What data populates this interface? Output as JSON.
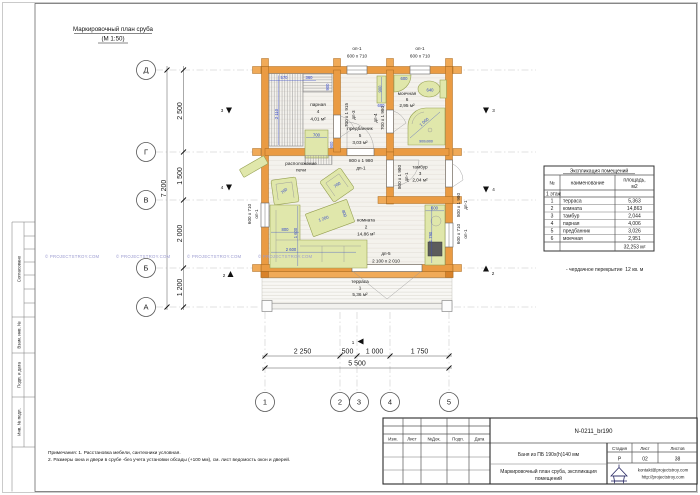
{
  "sheet": {
    "plan_title_1": "Маркировочный план сруба",
    "plan_title_2": "(М 1:50)",
    "watermark": "© PROJECTSTROY.COM",
    "note_1": "Примечания: 1. Расстановка мебели, сантехники условная.",
    "note_2": "2. Размеры окна и двери в срубе -без учета установки обсады (+100 мм), см. лист ведомость окон и дверей."
  },
  "frame": {
    "approved": "Согласовано",
    "replace_inv": "Взам. инв. №",
    "sign_date": "Подп. и дата",
    "inv_num": "Инв. № подл."
  },
  "axes": {
    "v": [
      "Д",
      "Г",
      "В",
      "Б",
      "А"
    ],
    "h": [
      "1",
      "2",
      "3",
      "4",
      "5"
    ]
  },
  "dims": {
    "left": [
      "2 500",
      "1 500",
      "2 000",
      "1 200"
    ],
    "left_total": "7 200",
    "bottom": [
      "2 250",
      "500",
      "1 000",
      "1 750"
    ],
    "bottom_total": "5 500"
  },
  "openings": {
    "win": "оп-1",
    "win_size": "600 х 710",
    "d1": "дп-1",
    "d1_size": "800 х 1 980",
    "d3": "дп-3",
    "d3_size": "700 х 1 915",
    "d4": "дп-4",
    "d4_size": "700 х 1 980",
    "d5": "дп-5",
    "d5_size": "2 100 х 2 010"
  },
  "rooms": {
    "parnaya": {
      "name": "парная",
      "num": "4",
      "area": "4,01 м²"
    },
    "predbannik": {
      "name": "предбанник",
      "num": "5",
      "area": "3,03 м²"
    },
    "moechnaya": {
      "name": "моечная",
      "num": "6",
      "area": "2,95 м²"
    },
    "komnata": {
      "name": "комната",
      "num": "2",
      "area": "14,86 м²"
    },
    "tambur": {
      "name": "тамбур",
      "num": "3",
      "area": "2,04 м²"
    },
    "terrasa": {
      "name": "терраса",
      "num": "1",
      "area": "5,36 м²"
    }
  },
  "stove": {
    "note_1": "расположение",
    "note_2": "печи"
  },
  "furn": {
    "bench_a": "570",
    "bench_b": "360",
    "bench_len": "2 110",
    "bench_side": "900",
    "stove_w": "700",
    "stove_d": "900",
    "shelf_len": "900",
    "shelf_w": "600",
    "sink": "600",
    "wc": "640",
    "shower_diag": "1 000",
    "shower_size": "900х900",
    "chair": "700",
    "table_l": "1 200",
    "table_w": "800",
    "sofa_w": "800",
    "sofa_l1": "1 600",
    "sofa_l2": "2 600",
    "kitchen_w": "600",
    "kitchen_l": "1 790"
  },
  "markers": {
    "s1": "1",
    "s2": "2",
    "s3": "3",
    "s4": "4"
  },
  "explication": {
    "title": "Экспликация помещений",
    "col_num": "№",
    "col_name": "наименование",
    "col_area_1": "площадь,",
    "col_area_2": "м2",
    "floor": "1 этаж",
    "rows": [
      {
        "num": "1",
        "name": "терраса",
        "area": "5,363"
      },
      {
        "num": "2",
        "name": "комната",
        "area": "14,863"
      },
      {
        "num": "3",
        "name": "тамбур",
        "area": "2,044"
      },
      {
        "num": "4",
        "name": "парная",
        "area": "4,006"
      },
      {
        "num": "5",
        "name": "предбанник",
        "area": "3,026"
      },
      {
        "num": "6",
        "name": "моечная",
        "area": "2,951"
      }
    ],
    "total": "32,253 м²",
    "attic_note": "- чердачное перекрытие  12 кв. м"
  },
  "titleblock": {
    "doc_code": "N-0211_br190",
    "col_izm": "Изм.",
    "col_list": "Лист",
    "col_doc": "№Док.",
    "col_sign": "Подп.",
    "col_date": "Дата",
    "project": "Баня из ПБ 190х(h)140 мм",
    "sheet_name_1": "Маркировочный план сруба, экспликация",
    "sheet_name_2": "помещений",
    "stage_label": "Стадия",
    "stage": "Р",
    "sheet_label": "Лист",
    "sheet_num": "02",
    "sheets_label": "Листов",
    "sheets_total": "38",
    "email": "kontakt@projectstroy.com",
    "site": "http://projectstroy.com"
  }
}
